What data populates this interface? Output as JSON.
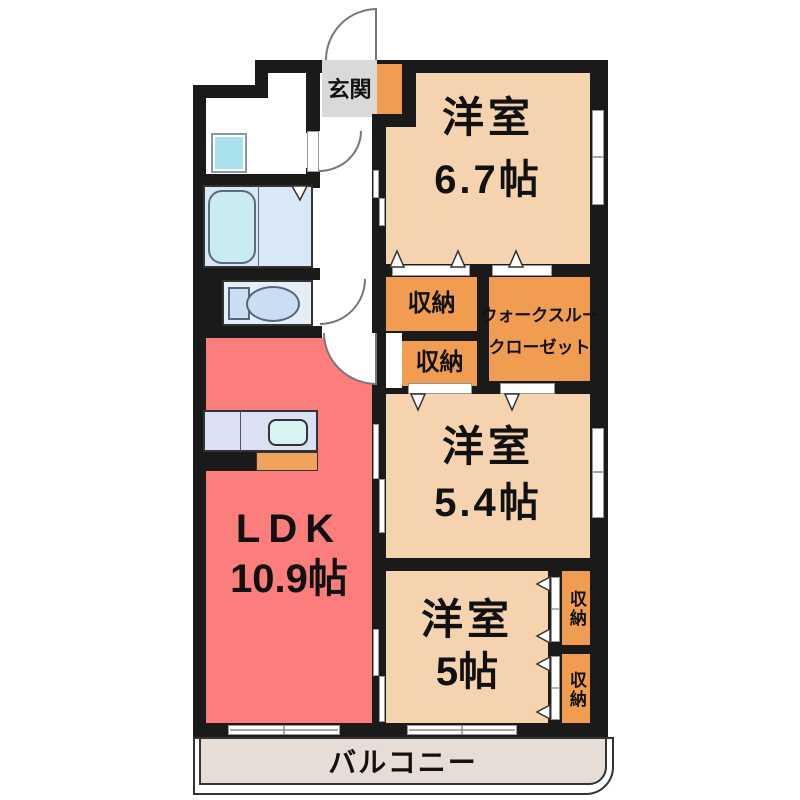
{
  "plan": {
    "entrance": {
      "label": "玄関"
    },
    "bedroom_1": {
      "name": "洋室",
      "area": "6.7帖"
    },
    "bedroom_2": {
      "name": "洋室",
      "area": "5.4帖"
    },
    "bedroom_3": {
      "name": "洋室",
      "area": "5帖"
    },
    "ldk": {
      "name": "LDK",
      "area": "10.9帖"
    },
    "storage_top": {
      "label": "収納"
    },
    "storage_mid": {
      "label": "収納"
    },
    "walk_through_closet": {
      "line1": "ウォークスルー",
      "line2": "クローゼット"
    },
    "storage_right_upper": {
      "label": "収納"
    },
    "storage_right_lower": {
      "label": "収納"
    },
    "balcony": {
      "label": "バルコニー"
    }
  },
  "colors": {
    "wall": "#1a1a1a",
    "room": "#f5d3ae",
    "storage": "#f09d52",
    "ldk": "#fb7e7c",
    "genkan": "#d9d9d9",
    "balcony": "#e6ded6",
    "bath": "#d9e8f6",
    "tub": "#c9ecf2",
    "basin": "#a9e2ec",
    "counter": "#dae1f4",
    "sink": "#d8f4f2",
    "toilet_room": "#e4eef9",
    "fixture": "#cbddf2",
    "counter_orange": "#f0a35c"
  }
}
